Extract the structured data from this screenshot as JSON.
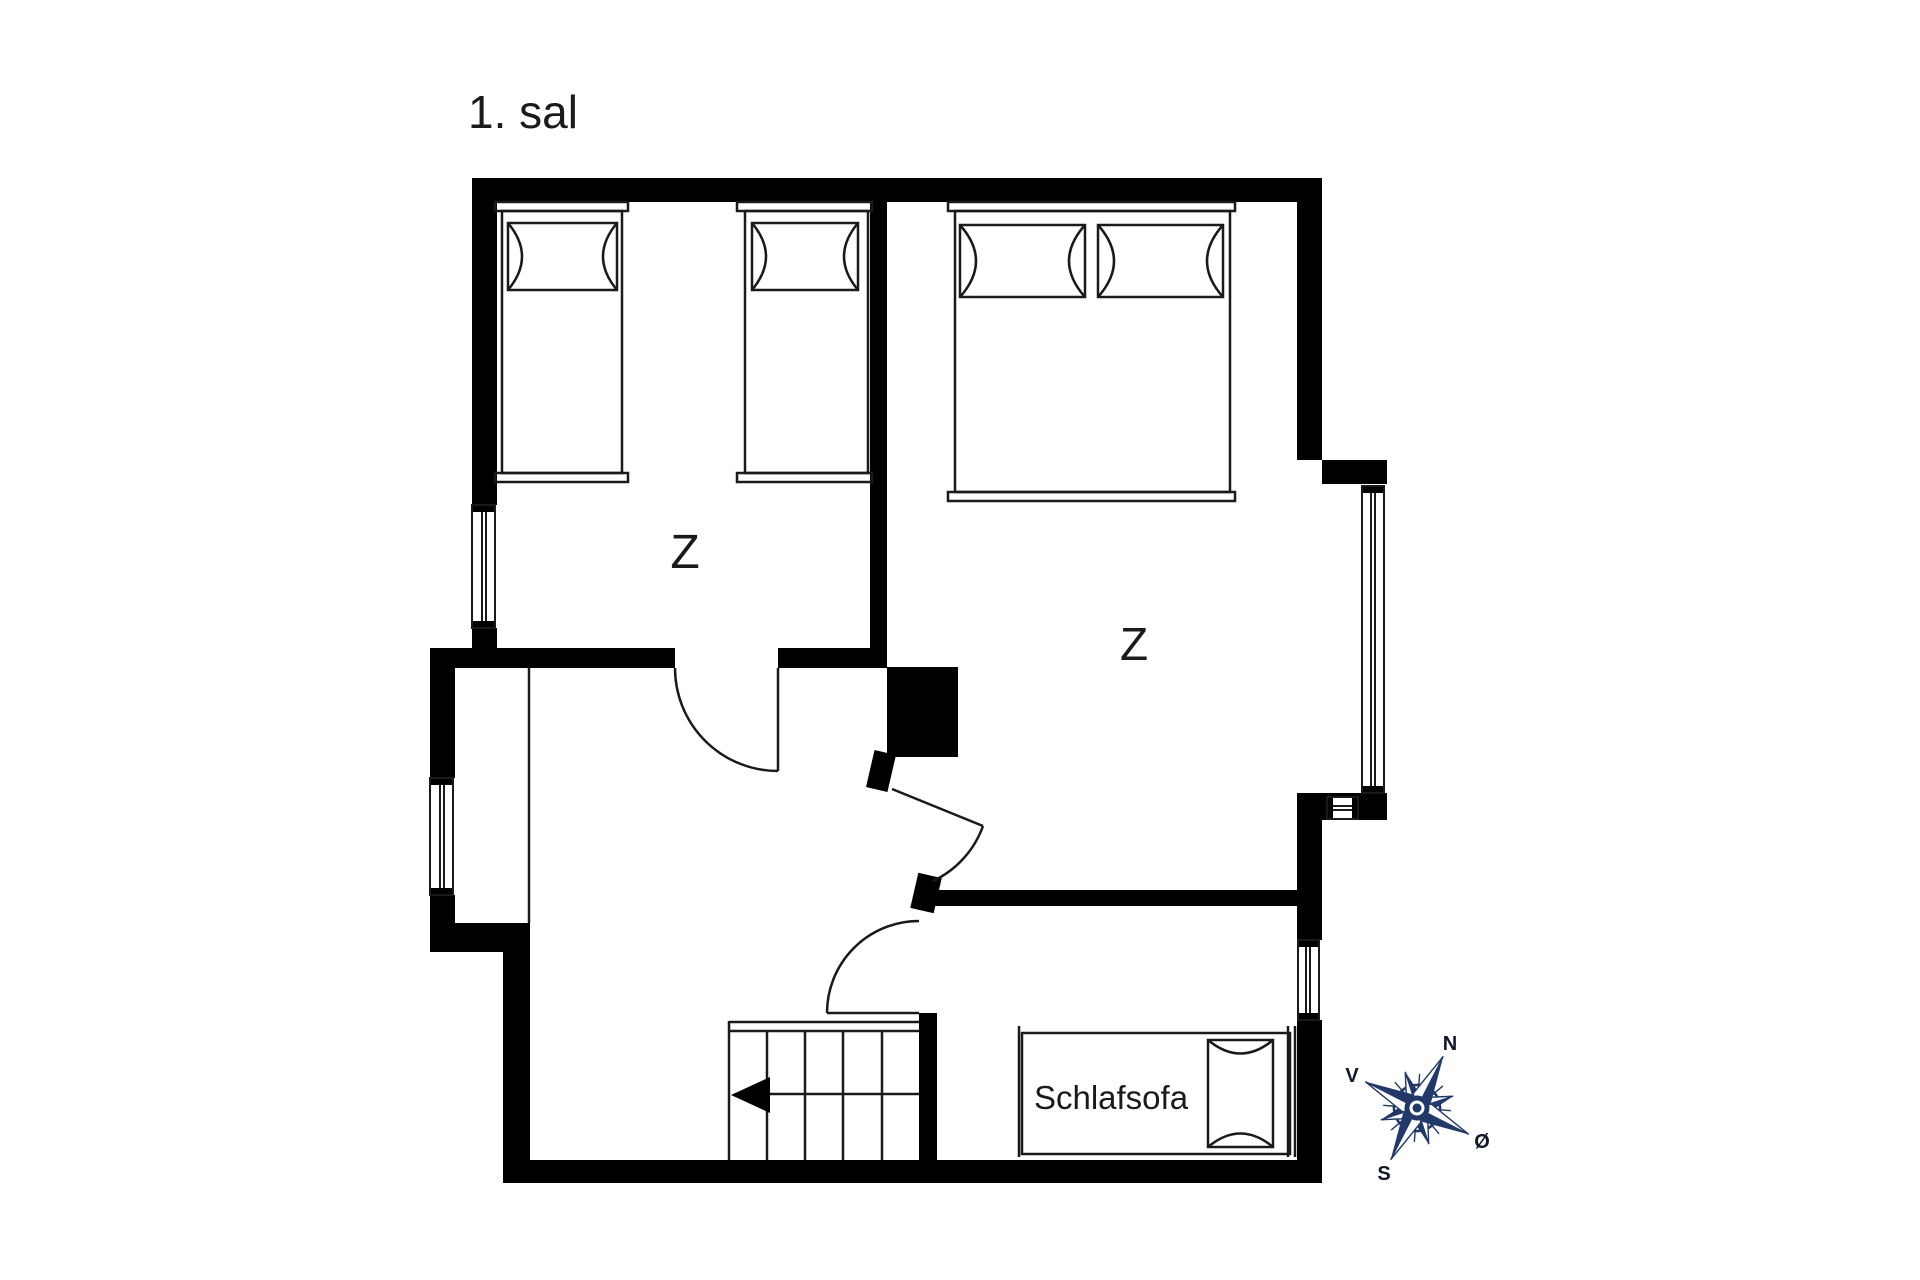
{
  "title": "1. sal",
  "rooms": {
    "bedroom_left_label": "Z",
    "bedroom_right_label": "Z"
  },
  "furniture": {
    "sleeper_sofa_label": "Schlafsofa"
  },
  "compass": {
    "north": "N",
    "west": "V",
    "south": "S",
    "east": "Ø"
  },
  "colors": {
    "walls": "#000000",
    "lines": "#1a1a1a",
    "background": "#ffffff",
    "compass": "#21386b",
    "compass_text": "#101828"
  }
}
